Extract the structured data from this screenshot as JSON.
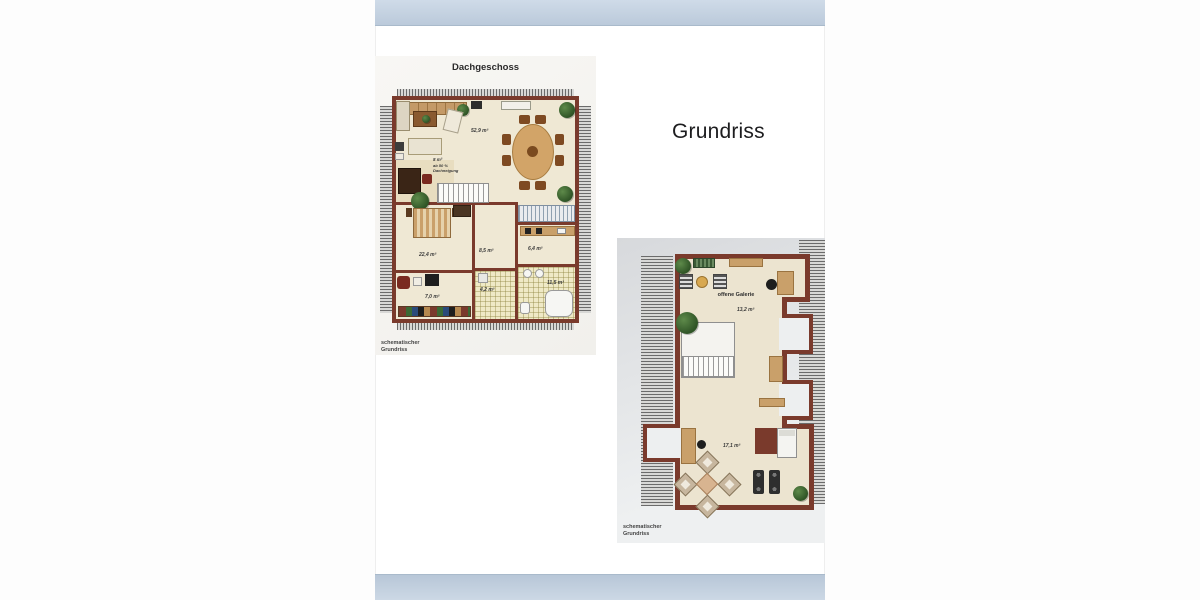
{
  "heading": {
    "text": "Grundriss"
  },
  "plan1": {
    "title": "Dachgeschoss",
    "caption": {
      "line1": "schematischer",
      "line2": "Grundriss"
    },
    "areas": {
      "living": "52,9 m²",
      "loft_nook": "8 m²",
      "loft_note1": "ab 50 %",
      "loft_note2": "Dachneigung",
      "bedroom": "22,4 m²",
      "room_center": "8,5 m²",
      "kitchen": "6,4 m²",
      "bath": "11,5 m²",
      "hall": "4,2 m²",
      "room_left": "7,0 m²"
    }
  },
  "plan2": {
    "room_label": "offene Galerie",
    "areas": {
      "gallery": "13,2 m²",
      "room": "17,1 m²"
    },
    "caption": {
      "line1": "schematischer",
      "line2": "Grundriss"
    }
  },
  "colors": {
    "banner_blue": "#c2d0e0",
    "wall_red": "#7a3a2c",
    "floor_cream": "#efe8d4"
  }
}
